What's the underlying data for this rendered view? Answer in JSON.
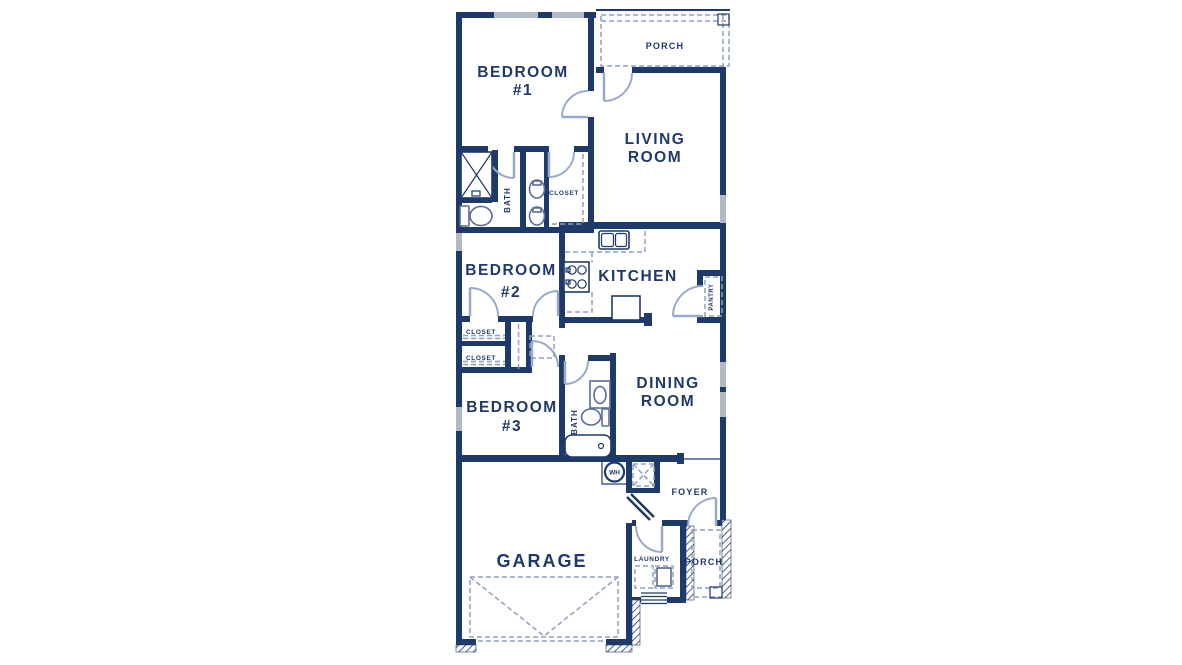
{
  "plan": {
    "type": "single-story house floor plan",
    "rooms": {
      "porch_top": {
        "label": "PORCH"
      },
      "bedroom1": {
        "line1": "BEDROOM",
        "line2": "#1"
      },
      "living": {
        "line1": "LIVING",
        "line2": "ROOM"
      },
      "bath1": {
        "label": "BATH"
      },
      "closet_master": {
        "label": "CLOSET"
      },
      "bedroom2": {
        "line1": "BEDROOM",
        "line2": "#2"
      },
      "kitchen": {
        "label": "KITCHEN"
      },
      "pantry": {
        "label": "PANTRY"
      },
      "closet_upper": {
        "label": "CLOSET"
      },
      "closet_lower": {
        "label": "CLOSET"
      },
      "dining": {
        "line1": "DINING",
        "line2": "ROOM"
      },
      "bedroom3": {
        "line1": "BEDROOM",
        "line2": "#3"
      },
      "bath2": {
        "label": "BATH"
      },
      "water_heater": {
        "label": "WH"
      },
      "foyer": {
        "label": "FOYER"
      },
      "garage": {
        "label": "GARAGE"
      },
      "laundry": {
        "label": "LAUNDRY"
      },
      "porch_bottom": {
        "label": "PORCH"
      }
    },
    "fixtures": [
      "shower",
      "toilet",
      "double-sink-vanity",
      "kitchen-sink",
      "stove",
      "refrigerator-peninsula",
      "bathtub",
      "washer-dryer",
      "water-heater",
      "garage-door",
      "steps"
    ]
  },
  "colors": {
    "wall": "#1e3a6a",
    "door": "#9aabca",
    "window": "#b3bac7",
    "dash": "#8d9fc2",
    "fixture": "#5a6e99",
    "background": "#ffffff"
  }
}
